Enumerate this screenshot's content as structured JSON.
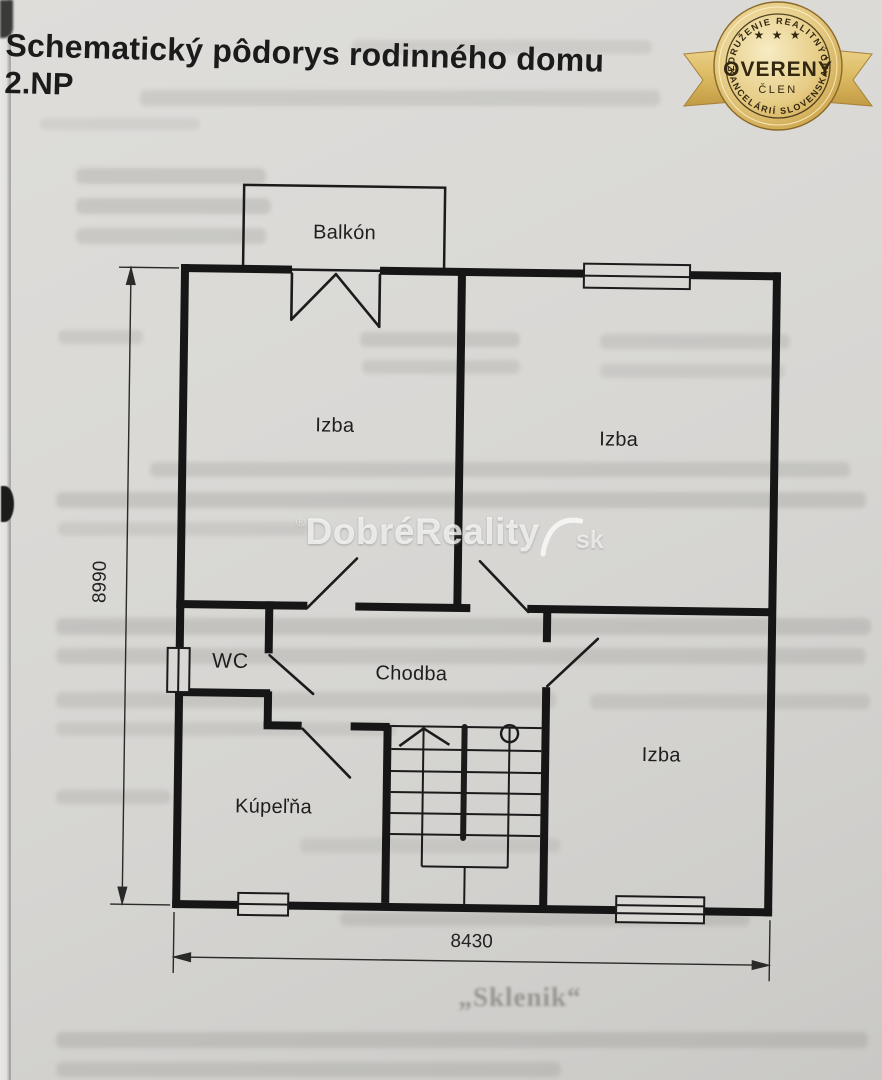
{
  "title": {
    "line1": "Schematický pôdorys rodinného domu",
    "line2": "2.NP"
  },
  "badge": {
    "arc_top": "ZDRUŽENIE REALITNÝCH",
    "stars": "★ ★ ★",
    "main": "OVERENÝ",
    "sub": "ČLEN",
    "arc_bottom": "KANCELÁRIÍ SLOVENSKA",
    "colors": {
      "gold_light": "#f5e7ba",
      "gold": "#d9b661",
      "gold_dark": "#a8803a",
      "ribbon": "#debf6e",
      "text": "#332711"
    }
  },
  "watermark": {
    "reg": "®",
    "name": "DobréReality",
    "tld": "sk"
  },
  "floorplan": {
    "rooms": [
      {
        "id": "balkon",
        "label": "Balkón"
      },
      {
        "id": "izba-top-left",
        "label": "Izba"
      },
      {
        "id": "izba-top-right",
        "label": "Izba"
      },
      {
        "id": "wc",
        "label": "WC"
      },
      {
        "id": "chodba",
        "label": "Chodba"
      },
      {
        "id": "kupelna",
        "label": "Kúpeľňa"
      },
      {
        "id": "izba-bottom-right",
        "label": "Izba"
      }
    ],
    "dimensions": {
      "vertical_mm": "8990",
      "horizontal_mm": "8430"
    }
  },
  "artifacts": {
    "bleed_heading": "„Sklenik“"
  },
  "colors": {
    "paper": "#d8d7d4",
    "ink": "#1a1a1a",
    "dimension": "#2a2a2a"
  }
}
